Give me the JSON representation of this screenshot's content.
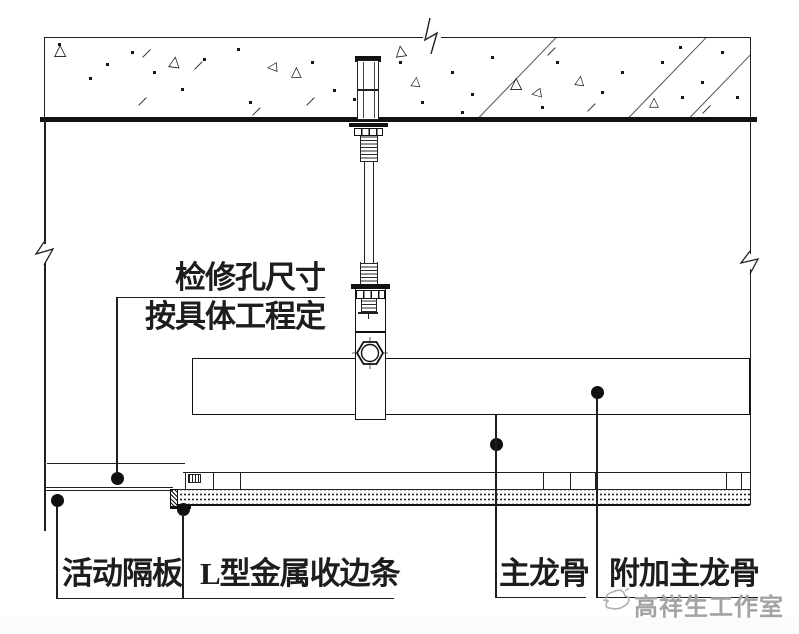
{
  "drawing": {
    "labels": {
      "access_note_line1": "检修孔尺寸",
      "access_note_line2": "按具体工程定",
      "partition": "活动隔板",
      "edge_trim": "L型金属收边条",
      "main_runner": "主龙骨",
      "additional_main_runner": "附加主龙骨"
    },
    "watermark": "高祥生工作室",
    "colors": {
      "line": "#1f1f1f",
      "watermark_gray": "#a3a3a3"
    }
  },
  "texture": {
    "triangles": [
      [
        9,
        4,
        16,
        0
      ],
      [
        124,
        16,
        15,
        8
      ],
      [
        222,
        23,
        13,
        -95
      ],
      [
        246,
        27,
        14,
        0
      ],
      [
        350,
        5,
        15,
        -8
      ],
      [
        366,
        37,
        13,
        6
      ],
      [
        465,
        37,
        16,
        0
      ],
      [
        486,
        49,
        13,
        -100
      ],
      [
        530,
        36,
        13,
        8
      ],
      [
        604,
        58,
        13,
        0
      ]
    ],
    "dots": [
      [
        13,
        5
      ],
      [
        61,
        25
      ],
      [
        44,
        39
      ],
      [
        108,
        33
      ],
      [
        158,
        20
      ],
      [
        192,
        10
      ],
      [
        136,
        50
      ],
      [
        266,
        23
      ],
      [
        288,
        51
      ],
      [
        308,
        60
      ],
      [
        354,
        23
      ],
      [
        376,
        63
      ],
      [
        406,
        33
      ],
      [
        426,
        55
      ],
      [
        446,
        18
      ],
      [
        511,
        23
      ],
      [
        556,
        53
      ],
      [
        576,
        33
      ],
      [
        616,
        23
      ],
      [
        636,
        58
      ],
      [
        656,
        43
      ],
      [
        676,
        13
      ],
      [
        691,
        58
      ],
      [
        496,
        68
      ],
      [
        416,
        73
      ],
      [
        204,
        63
      ],
      [
        86,
        13
      ],
      [
        634,
        8
      ]
    ],
    "dashes": [
      [
        96,
        15
      ],
      [
        92,
        63
      ],
      [
        148,
        27
      ],
      [
        206,
        73
      ],
      [
        260,
        63
      ],
      [
        541,
        69
      ],
      [
        501,
        13
      ],
      [
        656,
        71
      ]
    ],
    "lines": [
      433,
      583,
      644
    ]
  }
}
